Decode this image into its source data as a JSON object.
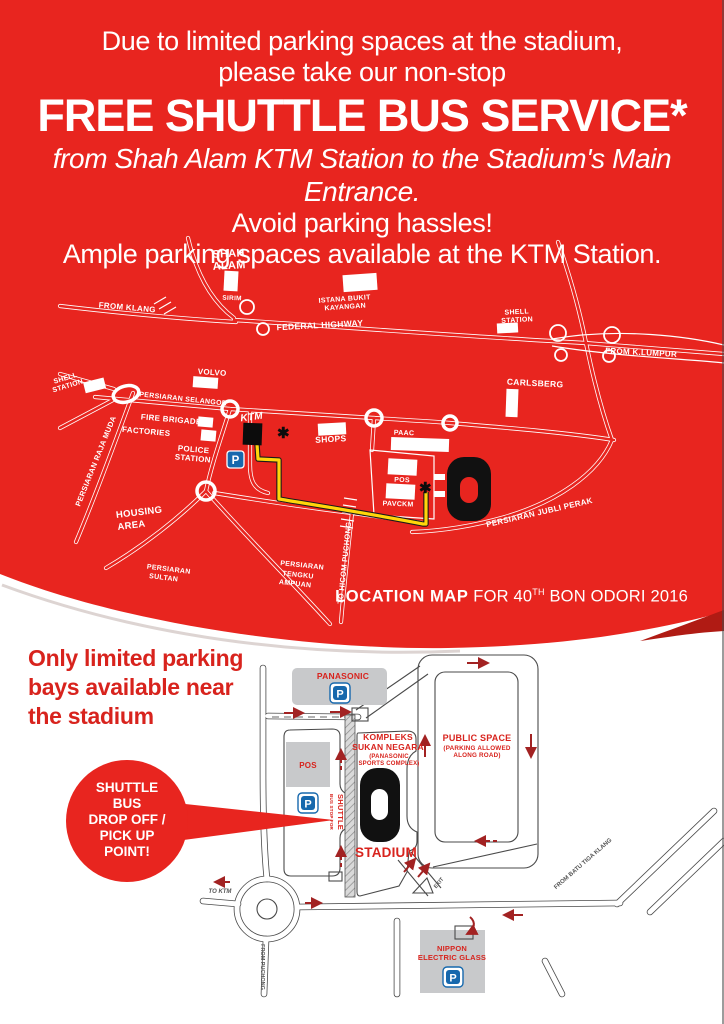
{
  "colors": {
    "red": "#e8251f",
    "dark_red_arrow": "#a22222",
    "map_red_text": "#d8231d",
    "building_gray": "#c8c9cb",
    "parking_blue": "#1668ad",
    "route_yellow": "#ffd60a"
  },
  "header": {
    "line1": "Due to limited parking spaces at the stadium,",
    "line2": "please take our non-stop",
    "line3": "FREE SHUTTLE BUS SERVICE*",
    "line4": "from Shah Alam KTM Station to the Stadium's Main Entrance.",
    "line5": "Avoid parking hassles!",
    "line6": "Ample parking spaces available at the KTM Station."
  },
  "caption": {
    "bold": "LOCATION MAP",
    "pre": " FOR 40",
    "sup": "TH",
    "post": " BON ODORI 2016"
  },
  "note": {
    "line1": "Only limited parking",
    "line2": "bays available near",
    "line3": "the stadium"
  },
  "callout": {
    "line1": "SHUTTLE",
    "line2": "BUS",
    "line3": "DROP OFF /",
    "line4": "PICK UP",
    "line5": "POINT!"
  },
  "icons": {
    "asterisk": "✱",
    "parking": "P"
  },
  "map1": {
    "labels": {
      "shah_alam_1": "SHAH",
      "shah_alam_2": "ALAM",
      "sirim": "SIRIM",
      "from_klang": "FROM KLANG",
      "istana_1": "ISTANA BUKIT",
      "istana_2": "KAYANGAN",
      "federal_highway": "FEDERAL HIGHWAY",
      "shell_right_1": "SHELL",
      "shell_right_2": "STATION",
      "from_klumpur": "FROM K.LUMPUR",
      "volvo": "VOLVO",
      "persiaran_selangor": "PERSIARAN SELANGOR",
      "carlsberg": "CARLSBERG",
      "shell_left_1": "SHELL",
      "shell_left_2": "STATION",
      "fire_brigade": "FIRE BRIGADE",
      "factories": "FACTORIES",
      "police_1": "POLICE",
      "police_2": "STATION",
      "ktm": "KTM",
      "shops": "SHOPS",
      "paac": "PAAC",
      "pos": "POS",
      "pavckm": "PAVCKM",
      "housing_1": "HOUSING",
      "housing_2": "AREA",
      "raja_muda": "PERSIARAN RAJA MUDA",
      "sultan_1": "PERSIARAN",
      "sultan_2": "SULTAN",
      "tengku_1": "PERSIARAN",
      "tengku_2": "TENGKU",
      "tengku_3": "AMPUAN",
      "to_hicom": "TO HICOM PUCHONG",
      "jubli_perak": "PERSIARAN JUBLI PERAK"
    }
  },
  "map2": {
    "labels": {
      "panasonic": "PANASONIC",
      "pos": "POS",
      "kompleks_1": "KOMPLEKS",
      "kompleks_2": "SUKAN NEGARA",
      "kompleks_3": "(PANASONIC",
      "kompleks_4": "SPORTS COMPLEX)",
      "public_1": "PUBLIC SPACE",
      "public_2": "(PARKING ALLOWED",
      "public_3": "ALONG ROAD)",
      "stadium": "STADIUM",
      "bus_stop_1": "BUS STOP FOR",
      "bus_stop_2": "SHUTTLE",
      "to_ktm": "TO KTM",
      "from_puchong": "FROM PUCHONG",
      "from_batu": "FROM BATU TIGA KLANG",
      "exit": "EXIT",
      "nippon_1": "NIPPON",
      "nippon_2": "ELECTRIC GLASS"
    }
  }
}
